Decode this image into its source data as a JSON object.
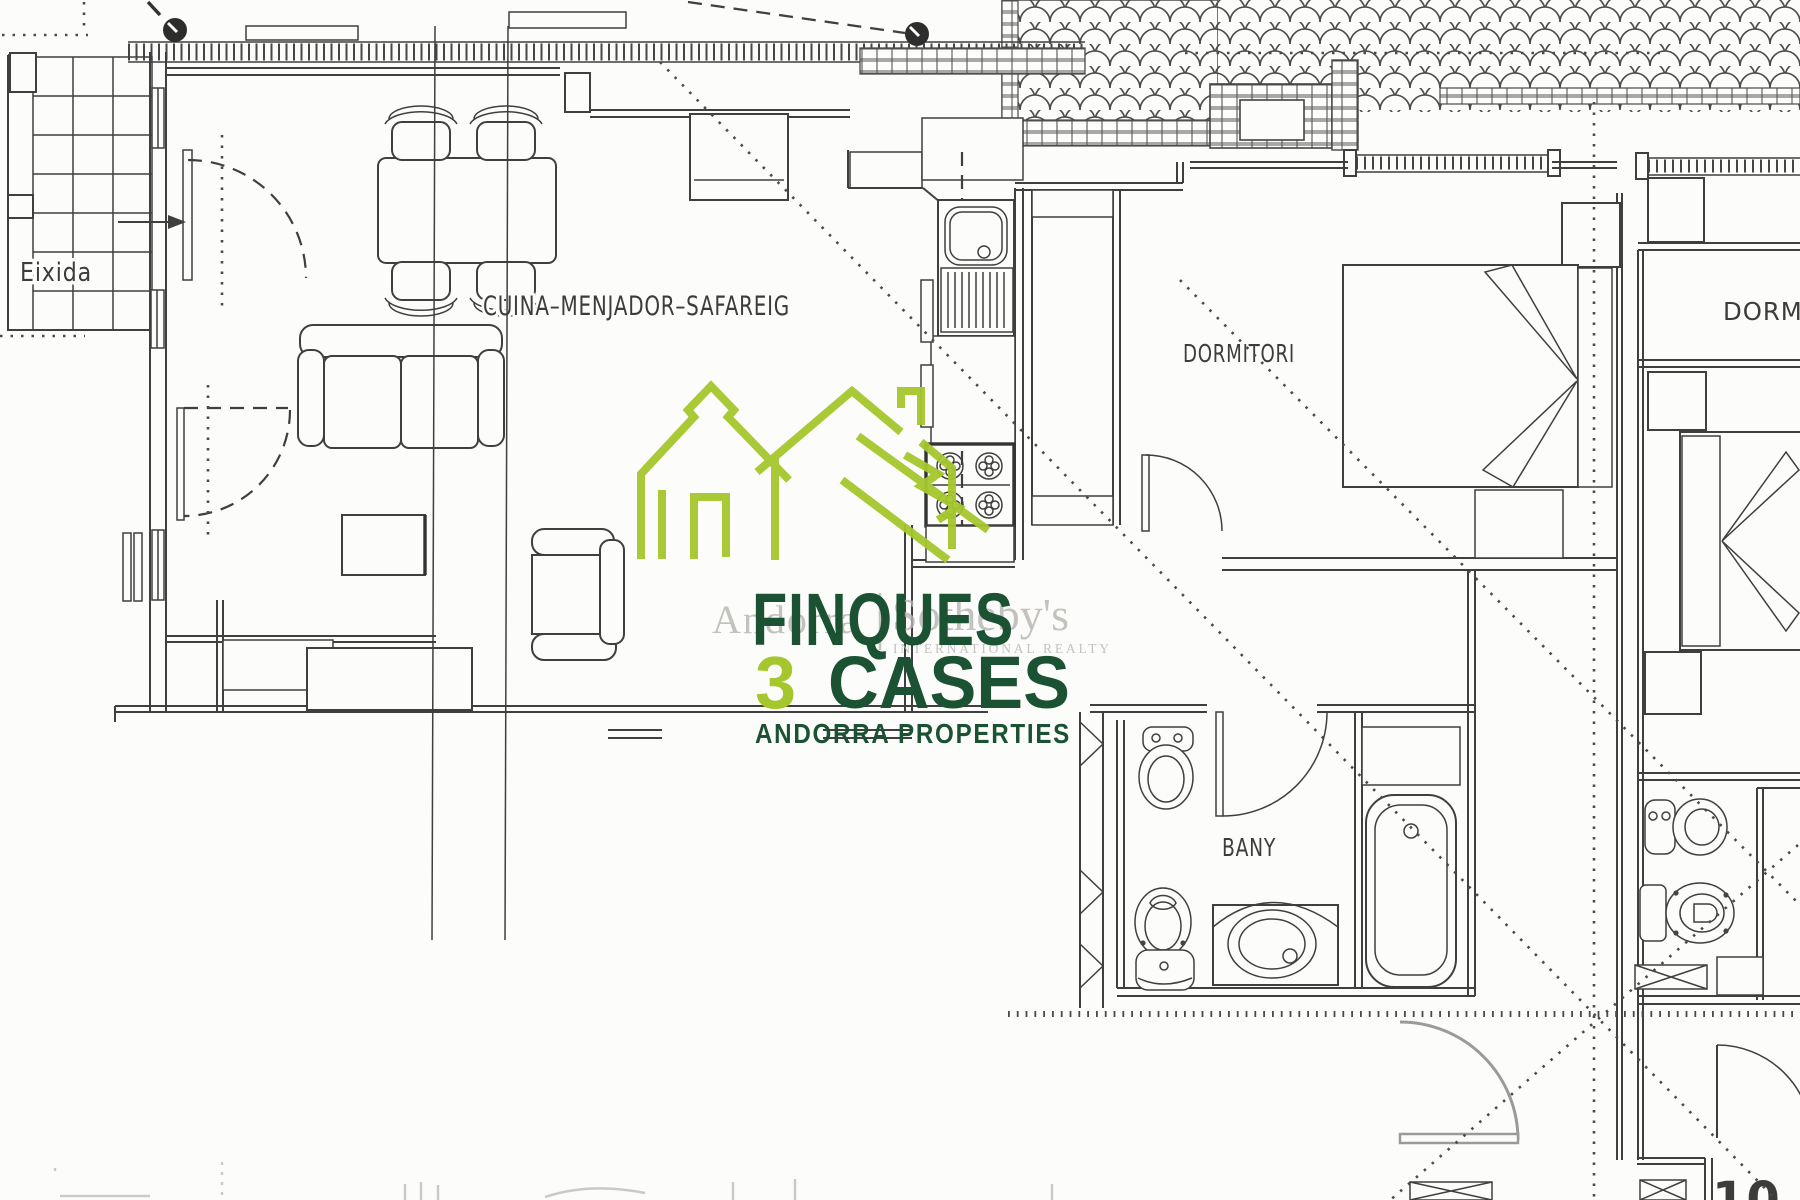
{
  "page": {
    "width": "1800",
    "height": "1200",
    "page_number": "10",
    "background": "#fcfcfa"
  },
  "floor_plan": {
    "labels": {
      "terrace": "Eixida",
      "living_kitchen": "CUINA–MENJADOR–SAFAREIG",
      "bedroom_main": "DORMITORI",
      "bedroom_right": "DORMITORI",
      "bathroom": "BANY"
    },
    "line_color": "#3f3f3f"
  },
  "watermark_brand": {
    "left": "Andorra",
    "right": "Sotheby's",
    "sub": "INTERNATIONAL REALTY",
    "color": "#b6b4b0"
  },
  "agency_logo": {
    "name": "FINQUES",
    "number": "3",
    "word": "CASES",
    "tagline": "ANDORRA PROPERTIES",
    "dark_green": "#1b5233",
    "light_green": "#a5c72d"
  }
}
